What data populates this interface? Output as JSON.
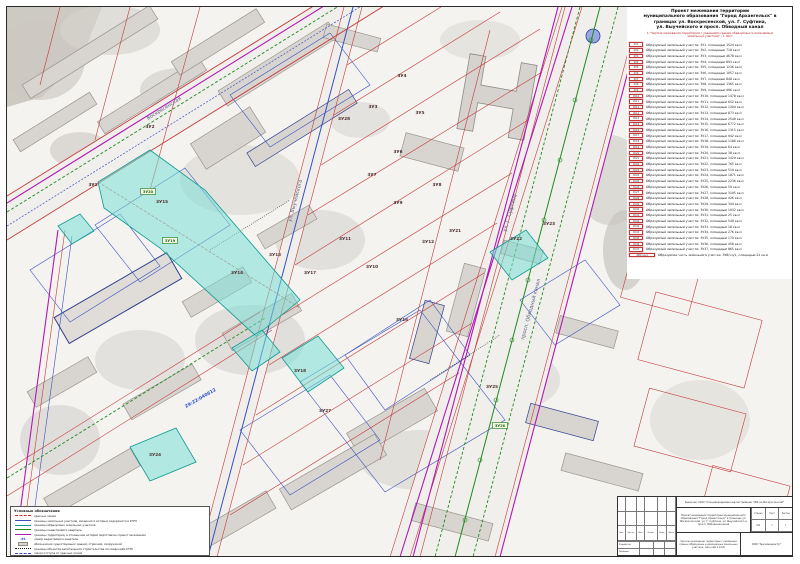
{
  "header": {
    "line1": "Проект межевания территории",
    "line2": "муниципального образования \"Город Архангельск\" в",
    "line3": "границах ул. Воскресенской, ул. Г. Суфтина,",
    "line4": "ул. Выучейского и просп. Обводный канал",
    "sub1": "1.\"Чертеж межевания территории с указанием границ образуемых и изменяемых",
    "sub2": "земельных участков\" - 1 лист"
  },
  "parcel_table": {
    "rows": [
      {
        "label": "ЗУ1",
        "text": "Образуемый земельный участок: ЗУ1, площадью 1524 кв.м"
      },
      {
        "label": "ЗУ2",
        "text": "Образуемый земельный участок: ЗУ2, площадью 718 кв.м"
      },
      {
        "label": "ЗУ3",
        "text": "Образуемый земельный участок: ЗУ3, площадью 4678 кв.м"
      },
      {
        "label": "ЗУ4",
        "text": "Образуемый земельный участок: ЗУ4, площадью 893 кв.м"
      },
      {
        "label": "ЗУ5",
        "text": "Образуемый земельный участок: ЗУ5, площадью 1236 кв.м"
      },
      {
        "label": "ЗУ6",
        "text": "Образуемый земельный участок: ЗУ6, площадью 1057 кв.м"
      },
      {
        "label": "ЗУ7",
        "text": "Образуемый земельный участок: ЗУ7, площадью 848 кв.м"
      },
      {
        "label": "ЗУ8",
        "text": "Образуемый земельный участок: ЗУ8, площадью 1365 кв.м"
      },
      {
        "label": "ЗУ9",
        "text": "Образуемый земельный участок: ЗУ9, площадью 996 кв.м"
      },
      {
        "label": "ЗУ10",
        "text": "Образуемый земельный участок: ЗУ10, площадью 1478 кв.м"
      },
      {
        "label": "ЗУ11",
        "text": "Образуемый земельный участок: ЗУ11, площадью 652 кв.м"
      },
      {
        "label": "ЗУ12",
        "text": "Образуемый земельный участок: ЗУ12, площадью 1204 кв.м"
      },
      {
        "label": "ЗУ13",
        "text": "Образуемый земельный участок: ЗУ13, площадью 873 кв.м"
      },
      {
        "label": "ЗУ14",
        "text": "Образуемый земельный участок: ЗУ14, площадью 2540 кв.м"
      },
      {
        "label": "ЗУ15",
        "text": "Образуемый земельный участок: ЗУ15, площадью 6772 кв.м"
      },
      {
        "label": "ЗУ16",
        "text": "Образуемый земельный участок: ЗУ16, площадью 1315 кв.м"
      },
      {
        "label": "ЗУ17",
        "text": "Образуемый земельный участок: ЗУ17, площадью 942 кв.м"
      },
      {
        "label": "ЗУ18",
        "text": "Образуемый земельный участок: ЗУ18, площадью 1186 кв.м"
      },
      {
        "label": "ЗУ19",
        "text": "Образуемый земельный участок: ЗУ19, площадью 64 кв.м"
      },
      {
        "label": "ЗУ20",
        "text": "Образуемый земельный участок: ЗУ20, площадью 38 кв.м"
      },
      {
        "label": "ЗУ21",
        "text": "Образуемый земельный участок: ЗУ21, площадью 1429 кв.м"
      },
      {
        "label": "ЗУ22",
        "text": "Образуемый земельный участок: ЗУ22, площадью 765 кв.м"
      },
      {
        "label": "ЗУ23",
        "text": "Образуемый земельный участок: ЗУ23, площадью 510 кв.м"
      },
      {
        "label": "ЗУ24",
        "text": "Образуемый земельный участок: ЗУ24, площадью 1871 кв.м"
      },
      {
        "label": "ЗУ25",
        "text": "Образуемый земельный участок: ЗУ25, площадью 2236 кв.м"
      },
      {
        "label": "ЗУ26",
        "text": "Образуемый земельный участок: ЗУ26, площадью 59 кв.м"
      },
      {
        "label": "ЗУ27",
        "text": "Образуемый земельный участок: ЗУ27, площадью 3105 кв.м"
      },
      {
        "label": "ЗУ28",
        "text": "Образуемый земельный участок: ЗУ28, площадью 426 кв.м"
      },
      {
        "label": "ЗУ29",
        "text": "Образуемый земельный участок: ЗУ29, площадью 344 кв.м"
      },
      {
        "label": "ЗУ30",
        "text": "Образуемый земельный участок: ЗУ30, площадью 1032 кв.м"
      },
      {
        "label": "ЗУ31",
        "text": "Образуемый земельный участок: ЗУ31, площадью 25 кв.м"
      },
      {
        "label": "ЗУ32",
        "text": "Образуемый земельный участок: ЗУ32, площадью 540 кв.м"
      },
      {
        "label": "ЗУ33",
        "text": "Образуемый земельный участок: ЗУ33, площадью 18 кв.м"
      },
      {
        "label": "ЗУ34",
        "text": "Образуемый земельный участок: ЗУ34, площадью 276 кв.м"
      },
      {
        "label": "ЗУ35",
        "text": "Образуемый земельный участок: ЗУ35, площадью 170 кв.м"
      },
      {
        "label": "ЗУ36",
        "text": "Образуемый земельный участок: ЗУ36, площадью 458 кв.м"
      },
      {
        "label": "ЗУ37",
        "text": "Образуемый земельный участок: ЗУ37, площадью 865 кв.м"
      }
    ],
    "part_row": {
      "label": "ЗУ8/чзу1",
      "text": "Образуемая часть земельного участка: ЗУ8/чзу1, площадью 22 кв.м"
    }
  },
  "legend": {
    "title": "Условные обозначения",
    "items": [
      {
        "sample": "red",
        "label": "красные линии"
      },
      {
        "sample": "blue",
        "label": "границы земельных участков, сведения о которых содержатся в ЕГРН"
      },
      {
        "sample": "teal",
        "label": "границы образуемых земельных участков"
      },
      {
        "sample": "green",
        "label": "границы кадастрового квартала"
      },
      {
        "sample": "magenta",
        "label": "границы территории, в отношении которой подготовлен проект межевания"
      },
      {
        "sample": "quarter",
        "label": "номер кадастрового квартала"
      },
      {
        "sample": "graybox",
        "label": "обозначение существующих зданий, строений, сооружений"
      },
      {
        "sample": "dotted",
        "label": "границы объектов капитального строительства по сведениям ЕГРН"
      },
      {
        "sample": "bluedash",
        "label": "линия отступа от красных линий"
      }
    ],
    "quarter_sample": ":91"
  },
  "stamp": {
    "customer": "Заказчик: ООО \"Специализированный застройщик \"ЖК на Воскресенской\"",
    "project": "Проект межевания территории муниципального образования \"Город Архангельск\" в границах ул. Воскресенской, ул. Г. Суфтина, ул. Выучейского и просп. Обводный канал",
    "stage_label": "Стадия",
    "sheet_label": "Лист",
    "sheets_label": "Листов",
    "stage": "ПМ",
    "sheet": "1",
    "sheets": "1",
    "drawing": "Чертеж межевания территории с указанием границ образуемых и изменяемых земельных участков, масштаб 1:1000",
    "org": "ООО \"Архземкадастр\"",
    "cols": [
      "Изм.",
      "Кол.уч.",
      "Лист",
      "№ док.",
      "Подп.",
      "Дата"
    ],
    "roles": [
      "Разработал",
      "Проверил"
    ]
  },
  "map": {
    "street_labels": [
      {
        "text": "Воскресенская",
        "x": 148,
        "y": 120,
        "rot": -32
      },
      {
        "text": "ул. Выучейского",
        "x": 291,
        "y": 222,
        "rot": -75
      },
      {
        "text": "ул. Г. Суфтина",
        "x": 506,
        "y": 232,
        "rot": -74
      },
      {
        "text": "просп. Обводный канал",
        "x": 524,
        "y": 340,
        "rot": -75
      }
    ],
    "quarter_labels": [
      {
        "text": "29:22:040612",
        "x": 186,
        "y": 408,
        "rot": -30
      }
    ],
    "parcel_labels": [
      {
        "text": "ЗУ1",
        "x": 93,
        "y": 186,
        "box": false
      },
      {
        "text": "ЗУ2",
        "x": 150,
        "y": 128,
        "box": false
      },
      {
        "text": "ЗУ3",
        "x": 373,
        "y": 108,
        "box": false
      },
      {
        "text": "ЗУ4",
        "x": 402,
        "y": 77,
        "box": false
      },
      {
        "text": "ЗУ5",
        "x": 420,
        "y": 114,
        "box": false
      },
      {
        "text": "ЗУ6",
        "x": 398,
        "y": 153,
        "box": false
      },
      {
        "text": "ЗУ7",
        "x": 372,
        "y": 176,
        "box": false
      },
      {
        "text": "ЗУ8",
        "x": 437,
        "y": 186,
        "box": false
      },
      {
        "text": "ЗУ9",
        "x": 398,
        "y": 204,
        "box": false
      },
      {
        "text": "ЗУ10",
        "x": 372,
        "y": 268,
        "box": false
      },
      {
        "text": "ЗУ11",
        "x": 345,
        "y": 240,
        "box": false
      },
      {
        "text": "ЗУ12",
        "x": 428,
        "y": 243,
        "box": false
      },
      {
        "text": "ЗУ13",
        "x": 275,
        "y": 256,
        "box": false
      },
      {
        "text": "ЗУ14",
        "x": 237,
        "y": 274,
        "box": false
      },
      {
        "text": "ЗУ15",
        "x": 162,
        "y": 203,
        "box": false
      },
      {
        "text": "ЗУ16",
        "x": 402,
        "y": 321,
        "box": false
      },
      {
        "text": "ЗУ17",
        "x": 310,
        "y": 274,
        "box": false
      },
      {
        "text": "ЗУ18",
        "x": 300,
        "y": 372,
        "box": false
      },
      {
        "text": "ЗУ19",
        "x": 170,
        "y": 242,
        "box": true
      },
      {
        "text": "ЗУ20",
        "x": 148,
        "y": 193,
        "box": true
      },
      {
        "text": "ЗУ21",
        "x": 455,
        "y": 232,
        "box": false
      },
      {
        "text": "ЗУ22",
        "x": 516,
        "y": 240,
        "box": false
      },
      {
        "text": "ЗУ23",
        "x": 549,
        "y": 225,
        "box": false
      },
      {
        "text": "ЗУ24",
        "x": 155,
        "y": 456,
        "box": false
      },
      {
        "text": "ЗУ25",
        "x": 492,
        "y": 388,
        "box": false
      },
      {
        "text": "ЗУ26",
        "x": 500,
        "y": 427,
        "box": true
      },
      {
        "text": "ЗУ27",
        "x": 325,
        "y": 412,
        "box": false
      },
      {
        "text": "ЗУ28",
        "x": 344,
        "y": 120,
        "box": false
      }
    ],
    "colors": {
      "red_line": "#c43a3a",
      "blue_line": "#3a4fc0",
      "teal_line": "#0d9a90",
      "green_line": "#1f8a1f",
      "magenta_line": "#b318b3",
      "cyan_fill": "#7adfd6",
      "building_fill": "#d8d5d0"
    }
  }
}
